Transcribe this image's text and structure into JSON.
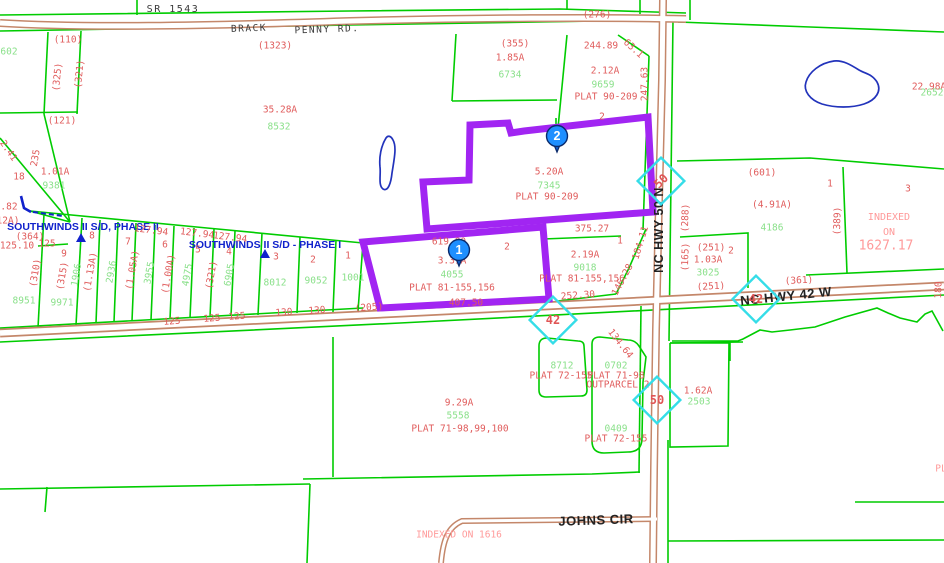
{
  "map": {
    "colors": {
      "parcel_line": "#00cc00",
      "parcel_text_green": "#8ae08a",
      "dimension_text_red": "#e05c5c",
      "index_text_pink": "#ff9a9a",
      "road_line": "#c4876a",
      "highlight_parcel": "#a125f2",
      "water_outline": "#2233bb",
      "shield_outline": "#35dde8",
      "marker_fill": "#1e8fff",
      "subdivision_text": "#1122cc",
      "road_text": "#222222"
    },
    "selected_parcels": [
      {
        "name": "parcel-2",
        "area": "5.20A",
        "parcel_num": "7345",
        "plat": "PLAT 90-209"
      },
      {
        "name": "parcel-1",
        "area": "3.31A",
        "parcel_num": "4055",
        "plat": "PLAT 81-155,156"
      }
    ],
    "markers": [
      {
        "n": "1",
        "x": 459,
        "y": 250
      },
      {
        "n": "2",
        "x": 557,
        "y": 136
      }
    ],
    "shields": [
      {
        "n": "42",
        "x": 553,
        "y": 320,
        "nr": 0
      },
      {
        "n": "50",
        "x": 661,
        "y": 181,
        "nr": -45
      },
      {
        "n": "42",
        "x": 756,
        "y": 299,
        "nr": 0
      },
      {
        "n": "50",
        "x": 657,
        "y": 400,
        "nr": 0
      }
    ],
    "subdivision_markers": [
      {
        "x": 81,
        "y": 238
      },
      {
        "x": 265,
        "y": 254
      }
    ],
    "labels": [
      {
        "t": "SR 1543",
        "x": 173,
        "y": 10,
        "c": "k",
        "s": 10,
        "n": "road-label-sr1543"
      },
      {
        "t": "BRACK",
        "x": 249,
        "y": 29,
        "c": "k",
        "r": -2,
        "s": 9.5,
        "n": "road-label-brack"
      },
      {
        "t": "PENNY RD.",
        "x": 327,
        "y": 30,
        "c": "k",
        "r": -2,
        "s": 9.5,
        "n": "road-label-penny-rd"
      },
      {
        "t": "NC HWY 50 N",
        "x": 659,
        "y": 230,
        "c": "road",
        "r": -90,
        "s": 12.5,
        "n": "road-label-nc-hwy-50-n"
      },
      {
        "t": "NC HWY 42 W",
        "x": 786,
        "y": 296,
        "c": "road",
        "r": -6,
        "n": "road-label-nc-hwy-42-w"
      },
      {
        "t": "JOHNS CIR",
        "x": 596,
        "y": 520,
        "c": "road",
        "r": -2,
        "n": "road-label-johns-cir"
      },
      {
        "t": "SOUTHWINDS II S/D, PHASE II",
        "x": 83,
        "y": 227,
        "c": "b",
        "n": "subdivision-label"
      },
      {
        "t": "SOUTHWINDS II S/D - PHASE I",
        "x": 265,
        "y": 245,
        "c": "b",
        "n": "subdivision-label"
      },
      {
        "t": "(276)",
        "x": 597,
        "y": 15,
        "c": "r"
      },
      {
        "t": "(110)",
        "x": 68,
        "y": 40,
        "c": "r"
      },
      {
        "t": "602",
        "x": 9,
        "y": 52,
        "c": "g"
      },
      {
        "t": "(1323)",
        "x": 275,
        "y": 46,
        "c": "r"
      },
      {
        "t": "(355)",
        "x": 515,
        "y": 44,
        "c": "r"
      },
      {
        "t": "1.85A",
        "x": 510,
        "y": 58,
        "c": "r"
      },
      {
        "t": "6734",
        "x": 510,
        "y": 75,
        "c": "g"
      },
      {
        "t": "244.89",
        "x": 601,
        "y": 46,
        "c": "r"
      },
      {
        "t": "63.1",
        "x": 633,
        "y": 49,
        "c": "r",
        "r": 42
      },
      {
        "t": "2.12A",
        "x": 605,
        "y": 71,
        "c": "r"
      },
      {
        "t": "9659",
        "x": 603,
        "y": 85,
        "c": "g"
      },
      {
        "t": "PLAT 90-209",
        "x": 606,
        "y": 97,
        "c": "r"
      },
      {
        "t": "247.63",
        "x": 645,
        "y": 84,
        "c": "r",
        "r": -90
      },
      {
        "t": "2",
        "x": 602,
        "y": 117,
        "c": "r"
      },
      {
        "t": "22.98A",
        "x": 929,
        "y": 87,
        "c": "r"
      },
      {
        "t": "2652",
        "x": 932,
        "y": 93,
        "c": "g"
      },
      {
        "t": "35.28A",
        "x": 280,
        "y": 110,
        "c": "r"
      },
      {
        "t": "8532",
        "x": 279,
        "y": 127,
        "c": "g"
      },
      {
        "t": "(325)",
        "x": 58,
        "y": 77,
        "c": "r",
        "r": -84
      },
      {
        "t": "(321)",
        "x": 80,
        "y": 74,
        "c": "r",
        "r": -84
      },
      {
        "t": "(121)",
        "x": 62,
        "y": 121,
        "c": "r"
      },
      {
        "t": "2.41",
        "x": 8,
        "y": 151,
        "c": "r",
        "r": 55
      },
      {
        "t": "235",
        "x": 36,
        "y": 158,
        "c": "r",
        "r": -80
      },
      {
        "t": "18",
        "x": 19,
        "y": 177,
        "c": "r"
      },
      {
        "t": "1.01A",
        "x": 55,
        "y": 172,
        "c": "r"
      },
      {
        "t": "9381",
        "x": 54,
        "y": 186,
        "c": "g"
      },
      {
        "t": ".82",
        "x": 9,
        "y": 207,
        "c": "r"
      },
      {
        "t": "12A)",
        "x": 8,
        "y": 221,
        "c": "r"
      },
      {
        "t": "(364)",
        "x": 30,
        "y": 237,
        "c": "r"
      },
      {
        "t": "125.10",
        "x": 17,
        "y": 246,
        "c": "r"
      },
      {
        "t": "125",
        "x": 47,
        "y": 244,
        "c": "r"
      },
      {
        "t": "9",
        "x": 64,
        "y": 254,
        "c": "r"
      },
      {
        "t": "8",
        "x": 92,
        "y": 236,
        "c": "r"
      },
      {
        "t": "127.94",
        "x": 151,
        "y": 231,
        "c": "r",
        "r": 7
      },
      {
        "t": "127.94",
        "x": 197,
        "y": 234,
        "c": "r",
        "r": 7
      },
      {
        "t": "127.94",
        "x": 230,
        "y": 238,
        "c": "r",
        "r": 7
      },
      {
        "t": "7",
        "x": 128,
        "y": 242,
        "c": "r"
      },
      {
        "t": "6",
        "x": 165,
        "y": 245,
        "c": "r"
      },
      {
        "t": "5",
        "x": 198,
        "y": 250,
        "c": "r"
      },
      {
        "t": "4",
        "x": 229,
        "y": 252,
        "c": "r"
      },
      {
        "t": "3",
        "x": 276,
        "y": 257,
        "c": "r"
      },
      {
        "t": "2",
        "x": 313,
        "y": 260,
        "c": "r"
      },
      {
        "t": "1",
        "x": 348,
        "y": 256,
        "c": "r"
      },
      {
        "t": "(310)",
        "x": 36,
        "y": 273,
        "c": "r",
        "r": -80
      },
      {
        "t": "(315)",
        "x": 63,
        "y": 276,
        "c": "r",
        "r": -80
      },
      {
        "t": "1906",
        "x": 77,
        "y": 275,
        "c": "g",
        "r": -80
      },
      {
        "t": "(1.13A)",
        "x": 91,
        "y": 272,
        "c": "r",
        "r": -80
      },
      {
        "t": "2936",
        "x": 112,
        "y": 272,
        "c": "g",
        "r": -80
      },
      {
        "t": "(1.05A)",
        "x": 133,
        "y": 270,
        "c": "r",
        "r": -80
      },
      {
        "t": "3955",
        "x": 150,
        "y": 273,
        "c": "g",
        "r": -80
      },
      {
        "t": "(1.00A)",
        "x": 169,
        "y": 274,
        "c": "r",
        "r": -80
      },
      {
        "t": "4975",
        "x": 188,
        "y": 275,
        "c": "g",
        "r": -80
      },
      {
        "t": "(321)",
        "x": 212,
        "y": 275,
        "c": "r",
        "r": -80
      },
      {
        "t": "6905",
        "x": 230,
        "y": 275,
        "c": "g",
        "r": -80
      },
      {
        "t": "8951",
        "x": 24,
        "y": 301,
        "c": "g"
      },
      {
        "t": "9971",
        "x": 62,
        "y": 303,
        "c": "g"
      },
      {
        "t": "8012",
        "x": 275,
        "y": 283,
        "c": "g"
      },
      {
        "t": "9052",
        "x": 316,
        "y": 281,
        "c": "g"
      },
      {
        "t": "1001",
        "x": 353,
        "y": 278,
        "c": "g"
      },
      {
        "t": "125",
        "x": 172,
        "y": 322,
        "c": "r",
        "r": -4
      },
      {
        "t": "125",
        "x": 212,
        "y": 319,
        "c": "r",
        "r": -4
      },
      {
        "t": "125",
        "x": 237,
        "y": 317,
        "c": "r",
        "r": -4
      },
      {
        "t": "130",
        "x": 284,
        "y": 313,
        "c": "r",
        "r": -4
      },
      {
        "t": "130",
        "x": 317,
        "y": 311,
        "c": "r",
        "r": -4
      },
      {
        "t": "(205)",
        "x": 369,
        "y": 308,
        "c": "r",
        "r": -4
      },
      {
        "t": "619.80",
        "x": 449,
        "y": 242,
        "c": "r"
      },
      {
        "t": "2",
        "x": 507,
        "y": 247,
        "c": "r"
      },
      {
        "t": "3.31A",
        "x": 452,
        "y": 261,
        "c": "r"
      },
      {
        "t": "4055",
        "x": 452,
        "y": 275,
        "c": "g"
      },
      {
        "t": "PLAT 81-155,156",
        "x": 452,
        "y": 288,
        "c": "r"
      },
      {
        "t": "407.50",
        "x": 466,
        "y": 303,
        "c": "r"
      },
      {
        "t": "5.20A",
        "x": 549,
        "y": 172,
        "c": "r"
      },
      {
        "t": "7345",
        "x": 549,
        "y": 186,
        "c": "g"
      },
      {
        "t": "PLAT 90-209",
        "x": 547,
        "y": 197,
        "c": "r"
      },
      {
        "t": "375.27",
        "x": 592,
        "y": 229,
        "c": "r"
      },
      {
        "t": "1",
        "x": 620,
        "y": 241,
        "c": "r"
      },
      {
        "t": "184.11",
        "x": 641,
        "y": 243,
        "c": "r",
        "r": -73
      },
      {
        "t": "2.19A",
        "x": 585,
        "y": 255,
        "c": "r"
      },
      {
        "t": "9018",
        "x": 585,
        "y": 268,
        "c": "g"
      },
      {
        "t": "PLAT 81-155,156",
        "x": 582,
        "y": 279,
        "c": "r"
      },
      {
        "t": "146.28",
        "x": 623,
        "y": 280,
        "c": "r",
        "r": -62
      },
      {
        "t": "252.30",
        "x": 578,
        "y": 296,
        "c": "r",
        "r": -4
      },
      {
        "t": "(165)",
        "x": 686,
        "y": 257,
        "c": "r",
        "r": -88
      },
      {
        "t": "(288)",
        "x": 686,
        "y": 218,
        "c": "r",
        "r": -88
      },
      {
        "t": "(251)",
        "x": 711,
        "y": 248,
        "c": "r"
      },
      {
        "t": "2",
        "x": 731,
        "y": 251,
        "c": "r"
      },
      {
        "t": "1.03A",
        "x": 708,
        "y": 260,
        "c": "r"
      },
      {
        "t": "3025",
        "x": 708,
        "y": 273,
        "c": "g"
      },
      {
        "t": "(251)",
        "x": 711,
        "y": 287,
        "c": "r",
        "r": -3
      },
      {
        "t": "(601)",
        "x": 762,
        "y": 173,
        "c": "r"
      },
      {
        "t": "(4.91A)",
        "x": 772,
        "y": 205,
        "c": "r"
      },
      {
        "t": "4186",
        "x": 772,
        "y": 228,
        "c": "g"
      },
      {
        "t": "1",
        "x": 830,
        "y": 184,
        "c": "r"
      },
      {
        "t": "3",
        "x": 908,
        "y": 189,
        "c": "r"
      },
      {
        "t": "(389)",
        "x": 838,
        "y": 221,
        "c": "r",
        "r": -88
      },
      {
        "t": "INDEXED",
        "x": 889,
        "y": 218,
        "c": "p",
        "s": 10
      },
      {
        "t": "ON",
        "x": 889,
        "y": 233,
        "c": "p",
        "s": 10
      },
      {
        "t": "1627.17",
        "x": 886,
        "y": 246,
        "c": "p",
        "s": 13
      },
      {
        "t": "(361)",
        "x": 799,
        "y": 281,
        "c": "r",
        "r": -3
      },
      {
        "t": "180",
        "x": 939,
        "y": 290,
        "c": "r",
        "r": -88
      },
      {
        "t": "134.64",
        "x": 620,
        "y": 344,
        "c": "r",
        "r": 52
      },
      {
        "t": "8712",
        "x": 562,
        "y": 366,
        "c": "g"
      },
      {
        "t": "PLAT 72-155",
        "x": 561,
        "y": 376,
        "c": "r"
      },
      {
        "t": "0702",
        "x": 616,
        "y": 366,
        "c": "g"
      },
      {
        "t": "PLAT 71-98",
        "x": 616,
        "y": 376,
        "c": "r"
      },
      {
        "t": "OUTPARCEL 2",
        "x": 618,
        "y": 385,
        "c": "r"
      },
      {
        "t": "1.62A",
        "x": 698,
        "y": 391,
        "c": "r"
      },
      {
        "t": "2503",
        "x": 699,
        "y": 402,
        "c": "g"
      },
      {
        "t": "9.29A",
        "x": 459,
        "y": 403,
        "c": "r"
      },
      {
        "t": "5558",
        "x": 458,
        "y": 416,
        "c": "g"
      },
      {
        "t": "PLAT 71-98,99,100",
        "x": 460,
        "y": 429,
        "c": "r"
      },
      {
        "t": "0409",
        "x": 616,
        "y": 429,
        "c": "g"
      },
      {
        "t": "PLAT 72-155",
        "x": 616,
        "y": 439,
        "c": "r"
      },
      {
        "t": "INDEXED ON 1616",
        "x": 459,
        "y": 535,
        "c": "p"
      },
      {
        "t": "PL",
        "x": 941,
        "y": 469,
        "c": "p"
      }
    ]
  }
}
